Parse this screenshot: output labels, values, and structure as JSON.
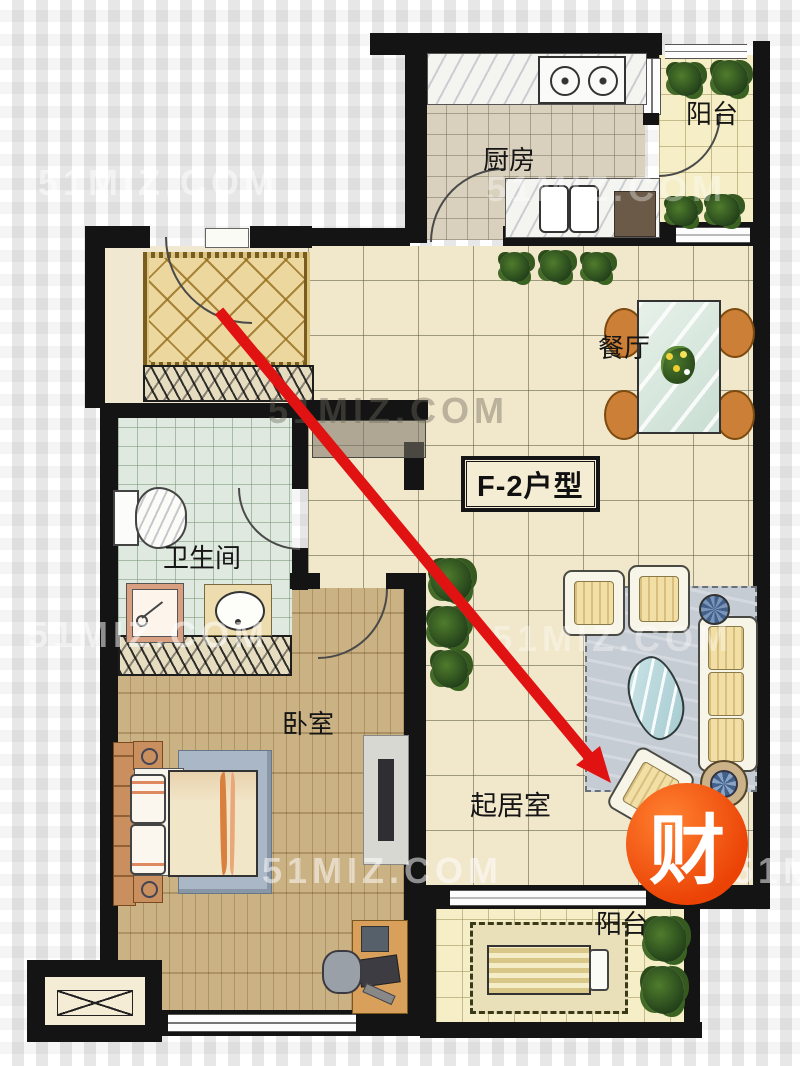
{
  "plan": {
    "unit_label": "F-2户型",
    "labels": {
      "kitchen": "厨房",
      "balcony_top": "阳台",
      "dining": "餐厅",
      "bathroom": "卫生间",
      "bedroom": "卧室",
      "living_room": "起居室",
      "balcony_bottom": "阳台"
    },
    "badge_text": "财",
    "watermark_text": "51MIZ.COM",
    "colors": {
      "badge": "#ee4708",
      "arrow": "#e01212",
      "wall": "#141414"
    }
  }
}
